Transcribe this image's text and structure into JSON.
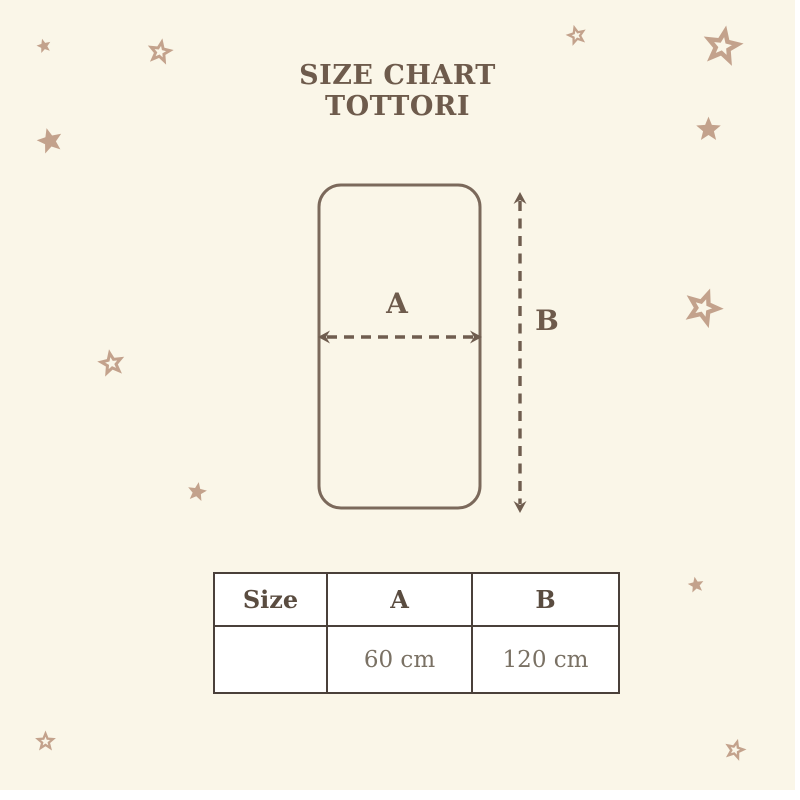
{
  "title": {
    "line1": "SIZE CHART",
    "line2": "TOTTORI"
  },
  "diagram": {
    "width_label": "A",
    "height_label": "B"
  },
  "size_table": {
    "headers": [
      "Size",
      "A",
      "B"
    ],
    "row": [
      "",
      "60 cm",
      "120 cm"
    ]
  },
  "icons": {
    "star_filled": "five-point filled star decoration",
    "star_outline": "five-point outlined star decoration"
  },
  "colors": {
    "page-bg": "#FFFFFF",
    "canvas-bg": "#FAF6E8",
    "star": "#C3A28C",
    "title-text": "#6E5B4C",
    "diagram-line": "#7B695B",
    "arrow": "#6F5D4F",
    "table-border": "#4A403A",
    "table-header-text": "#5A4C40",
    "table-value-text": "#7A7164",
    "table-bg": "#FFFFFF"
  }
}
